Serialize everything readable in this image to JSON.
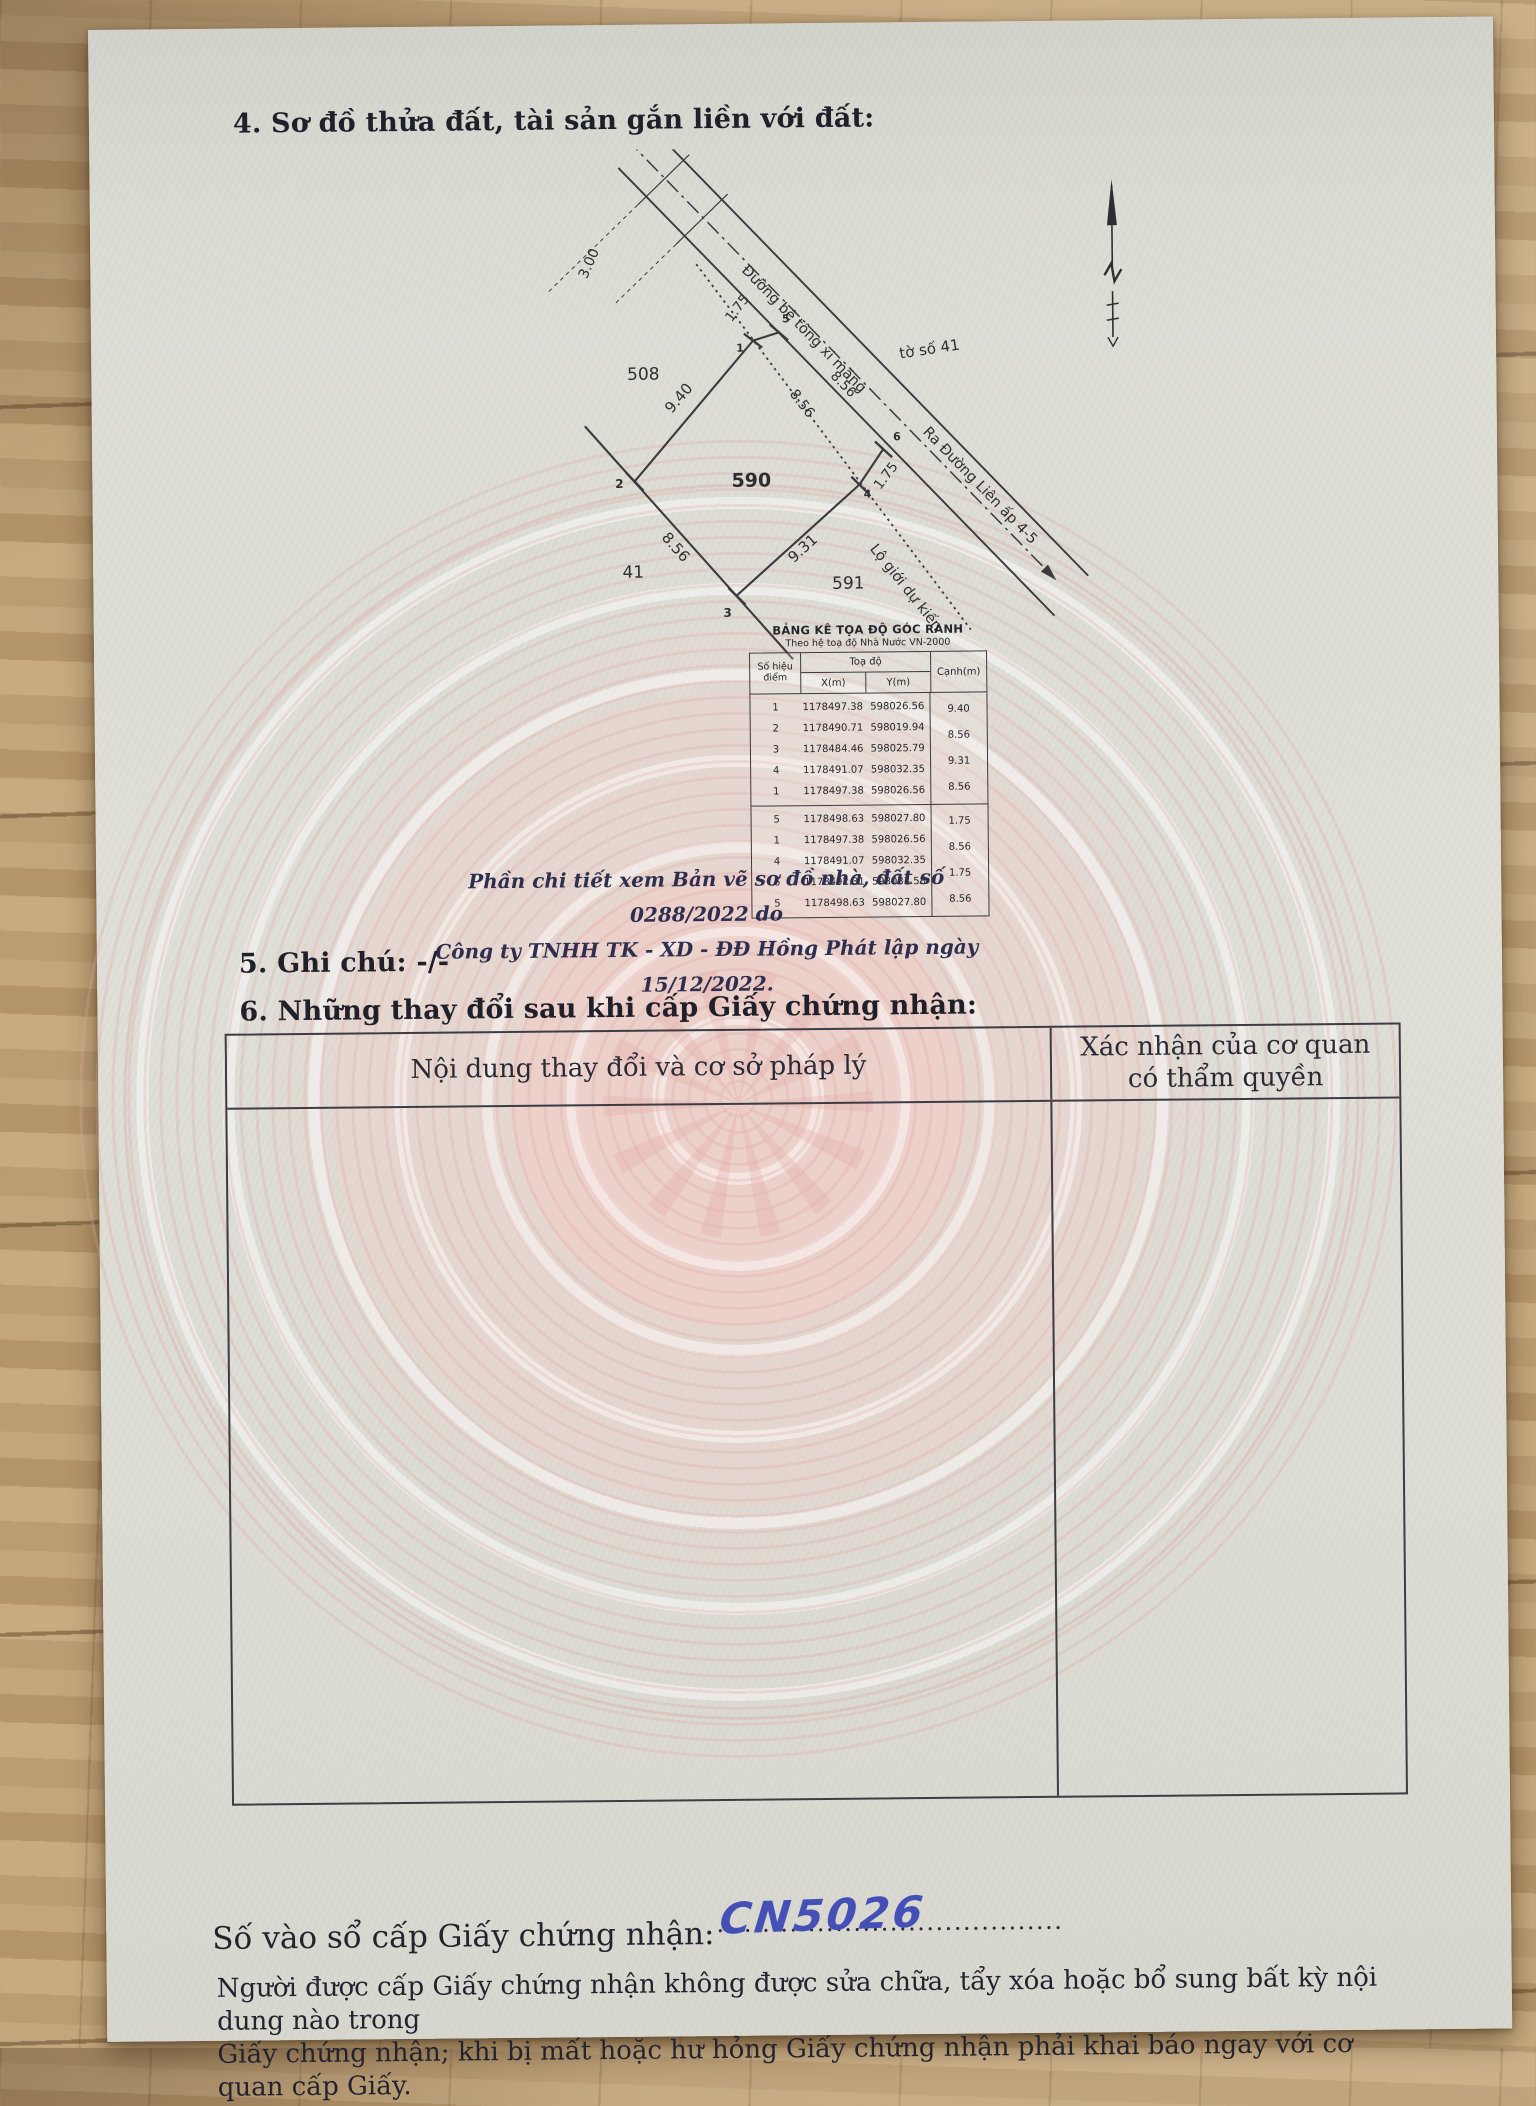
{
  "page": {
    "section4_title": "4. Sơ đồ thửa đất, tài sản gắn liền với đất:",
    "section5_title": "5. Ghi chú: -/-",
    "section6_title": "6. Những thay đổi sau khi cấp Giấy chứng nhận:"
  },
  "diagram": {
    "north_arrow": "north-arrow",
    "sheet_label": "tờ số 41",
    "road_label": "Đường bê tông xi măng",
    "road_exit_label": "Ra Đường Liên ấp 4-5",
    "boundary_label": "Lộ giới dự kiến",
    "parcel_main": "590",
    "parcel_top": "508",
    "parcel_left": "41",
    "parcel_bottom": "591",
    "dims": {
      "d12": "9.40",
      "d23": "8.56",
      "d34": "9.31",
      "d41": "8.56",
      "d56": "8.56",
      "d51": "1.75",
      "d46": "1.75",
      "road_width": "3.00"
    },
    "points": {
      "p1": "1",
      "p2": "2",
      "p3": "3",
      "p4": "4",
      "p5": "5",
      "p6": "6"
    }
  },
  "coord_table": {
    "title": "BẢNG KÊ TỌA ĐỘ GÓC RANH",
    "subtitle": "Theo hệ toạ độ Nhà Nước VN-2000",
    "col_point": "Số hiệu điểm",
    "col_coord": "Toạ độ",
    "col_x": "X(m)",
    "col_y": "Y(m)",
    "col_edge": "Cạnh(m)",
    "groups": [
      {
        "points": [
          "1",
          "2",
          "3",
          "4",
          "1"
        ],
        "x": [
          "1178497.38",
          "1178490.71",
          "1178484.46",
          "1178491.07",
          "1178497.38"
        ],
        "y": [
          "598026.56",
          "598019.94",
          "598025.79",
          "598032.35",
          "598026.56"
        ],
        "edges": [
          "9.40",
          "8.56",
          "9.31",
          "8.56"
        ]
      },
      {
        "points": [
          "5",
          "1",
          "4",
          "6",
          "5"
        ],
        "x": [
          "1178498.63",
          "1178497.38",
          "1178491.07",
          "1178492.31",
          "1178498.63"
        ],
        "y": [
          "598027.80",
          "598026.56",
          "598032.35",
          "598033.58",
          "598027.80"
        ],
        "edges": [
          "1.75",
          "8.56",
          "1.75",
          "8.56"
        ]
      }
    ]
  },
  "note": {
    "line1": "Phần chi tiết xem Bản vẽ sơ đồ nhà, đất số 0288/2022  do",
    "line2": "Công ty TNHH TK - XD - ĐĐ Hồng Phát lập ngày 15/12/2022."
  },
  "changes_table": {
    "col1_header": "Nội dung thay đổi và cơ sở pháp lý",
    "col2_header_line1": "Xác nhận của cơ quan",
    "col2_header_line2": "có thẩm quyền"
  },
  "registry": {
    "label": "Số vào sổ cấp Giấy chứng nhận:",
    "value": "CN5026",
    "dots": "..............................................",
    "ink_color": "#4550b6"
  },
  "footer": {
    "line1": "Người được cấp Giấy chứng nhận không được sửa chữa, tẩy xóa hoặc bổ sung bất kỳ nội dung nào trong",
    "line2": "Giấy chứng nhận; khi bị mất hoặc hư hỏng Giấy chứng nhận phải khai báo ngay với cơ quan cấp Giấy."
  }
}
